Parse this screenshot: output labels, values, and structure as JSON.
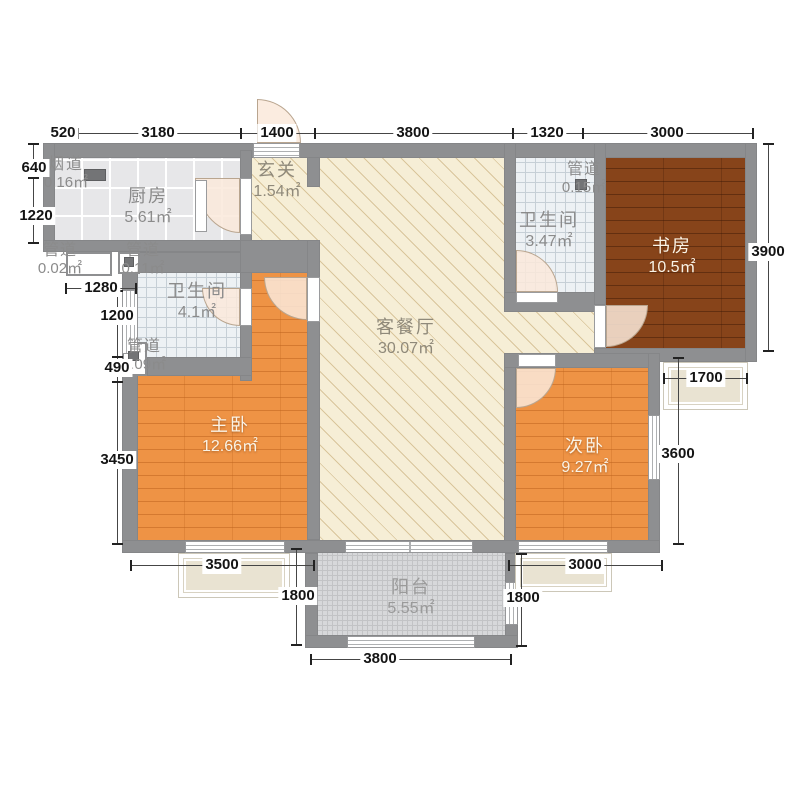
{
  "plan": {
    "rooms": {
      "kitchen": {
        "label": "厨房",
        "area": "5.61㎡"
      },
      "flue": {
        "label": "烟道",
        "area": "0.16㎡"
      },
      "duct_002": {
        "label": "管道",
        "area": "0.02㎡"
      },
      "duct_011": {
        "label": "管道",
        "area": "0.11㎡"
      },
      "duct_009": {
        "label": "管道",
        "area": "0.09㎡"
      },
      "duct_015": {
        "label": "管道",
        "area": "0.15㎡"
      },
      "hallway": {
        "label": "玄关",
        "area": "1.54㎡"
      },
      "bath_main": {
        "label": "卫生间",
        "area": "4.1㎡"
      },
      "bath_guest": {
        "label": "卫生间",
        "area": "3.47㎡"
      },
      "living": {
        "label": "客餐厅",
        "area": "30.07㎡"
      },
      "study": {
        "label": "书房",
        "area": "10.5㎡"
      },
      "master": {
        "label": "主卧",
        "area": "12.66㎡"
      },
      "second": {
        "label": "次卧",
        "area": "9.27㎡"
      },
      "balcony": {
        "label": "阳台",
        "area": "5.55㎡"
      }
    },
    "dims": {
      "top": [
        "520",
        "3180",
        "1400",
        "3800",
        "1320",
        "3000"
      ],
      "left": [
        "640",
        "1220"
      ],
      "left_inner": [
        "1280",
        "1200",
        "490",
        "3450"
      ],
      "right": [
        "3900",
        "1700",
        "3600"
      ],
      "bottom": [
        "3500",
        "1800",
        "3000",
        "1800",
        "3800"
      ]
    },
    "colors": {
      "wall": "#8e8f91",
      "living_floor": "#f6eed6",
      "hatch_line": "#d9c59b",
      "kitchen_tile": "#e7e7e9",
      "bath_tile": "#edf1f4",
      "study_wood": "#87441a",
      "bedroom_wood": "#ee9345",
      "balcony_tile": "#d7d8da",
      "bay_fill": "#e9e3d2",
      "dim_text": "#141414"
    }
  }
}
